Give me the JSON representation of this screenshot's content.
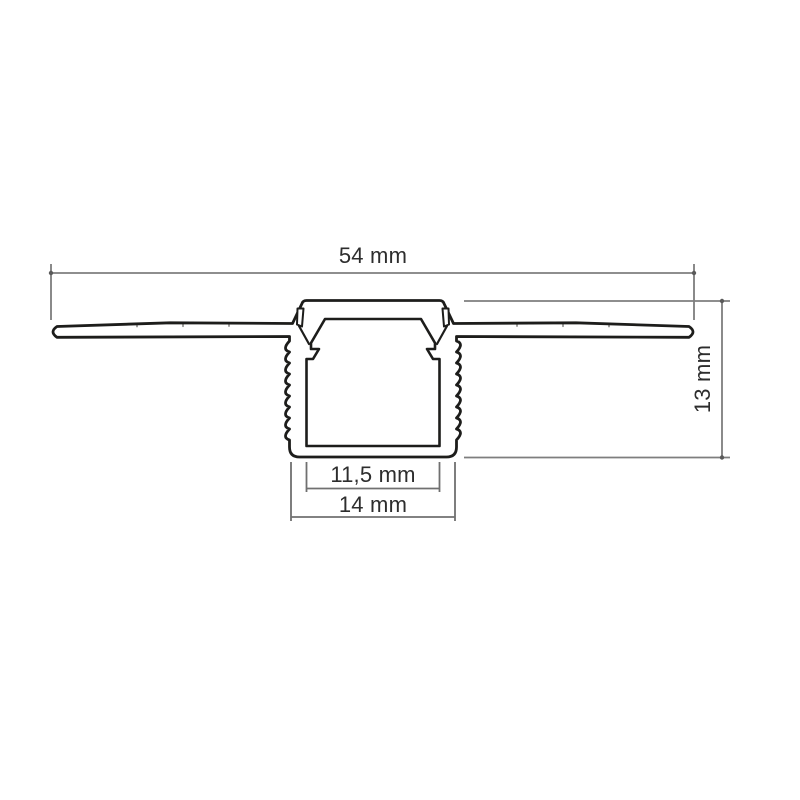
{
  "drawing": {
    "type": "technical-cross-section",
    "subject": "recessed trimless LED aluminium profile, dimensioned section view",
    "background": "#ffffff",
    "colors": {
      "outline": "#1d1d1b",
      "dimension_line": "#7e7e7e",
      "label_text": "#2d2d2d"
    },
    "dimensions": [
      {
        "id": "total_width",
        "label": "54 mm",
        "orientation": "horizontal",
        "position": "top"
      },
      {
        "id": "height",
        "label": "13 mm",
        "orientation": "vertical",
        "position": "right"
      },
      {
        "id": "inner_width",
        "label": "11,5 mm",
        "orientation": "horizontal",
        "position": "bottom-inner"
      },
      {
        "id": "outer_width",
        "label": "14 mm",
        "orientation": "horizontal",
        "position": "bottom-outer"
      }
    ]
  }
}
